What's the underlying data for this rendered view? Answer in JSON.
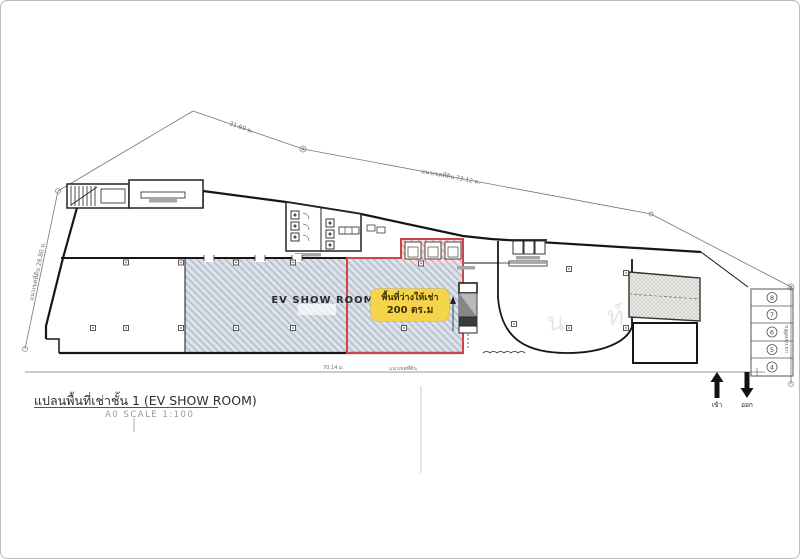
{
  "title_block": {
    "title": "แปลนพื้นที่เช่าชั้น 1 (EV SHOW ROOM)",
    "scale": "A0 SCALE 1:100"
  },
  "plan": {
    "showroom": {
      "label": "EV SHOW ROOM"
    },
    "rental_area": {
      "label_line1": "พื้นที่ว่างให้เช่า",
      "label_line2": "200 ตร.ม",
      "highlight_color": "#f5d34b",
      "outline_color": "#cf4444",
      "hatch_fill": "#dde3eb",
      "hatch_line": "#b2bccb"
    },
    "boundary_dimensions": {
      "top_left": "31.60 ม.",
      "top_right": "แนวเขตที่ดิน  73.12 ม.",
      "left": "แนวเขตที่ดิน  28.80 ม.",
      "bottom_length": "70.14 ม.",
      "bottom_label": "แนวเขตที่ดิน",
      "right_label": "แนวเขตที่ดิน"
    },
    "parking": {
      "numbers": [
        "8",
        "7",
        "6",
        "5",
        "4"
      ]
    },
    "entrance": {
      "in_label": "เข้า",
      "out_label": "ออก"
    },
    "watermark": {
      "char1": "น",
      "char2": "ท์"
    }
  }
}
